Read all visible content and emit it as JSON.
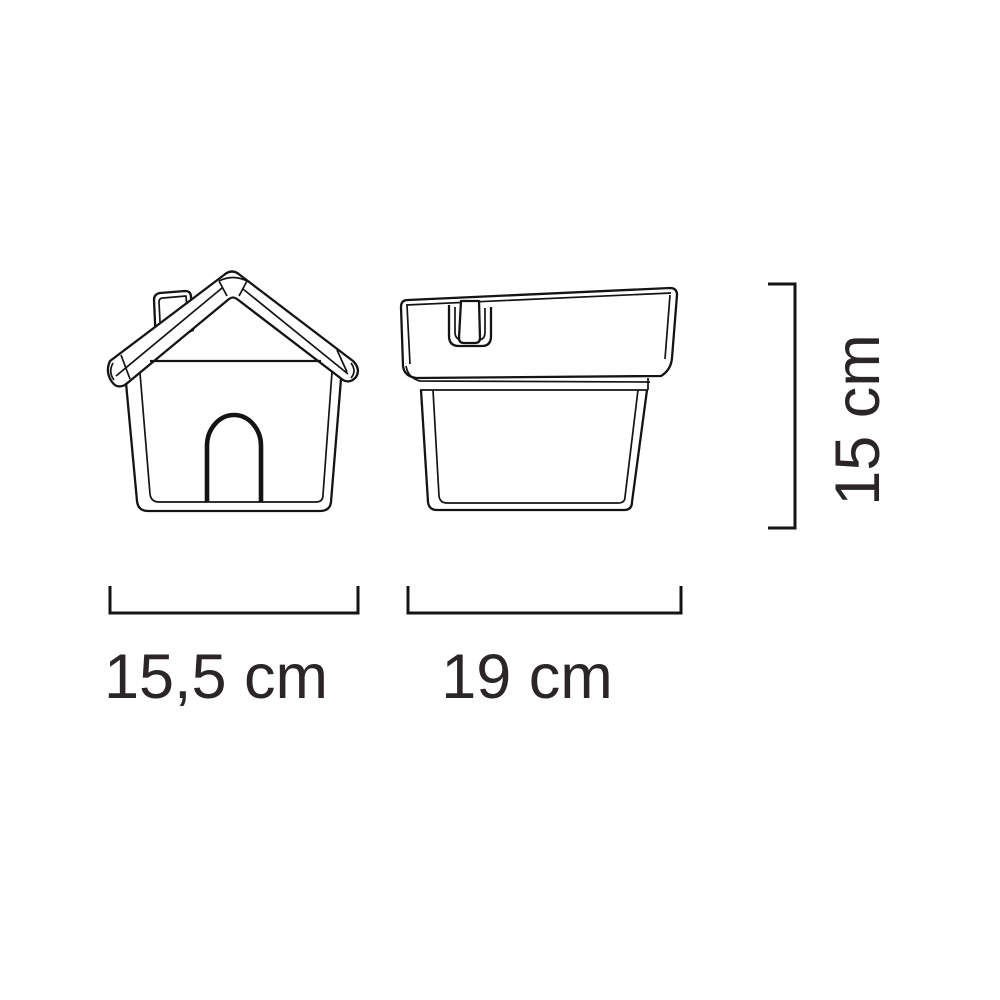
{
  "diagram": {
    "type": "product-dimension-drawing",
    "colors": {
      "background": "#ffffff",
      "line": "#141414",
      "text": "#2a2627"
    },
    "front_view": {
      "name": "front view",
      "width_label": "15,5 cm"
    },
    "side_view": {
      "name": "side view",
      "width_label": "19 cm"
    },
    "height_label": "15 cm",
    "unit": "cm"
  }
}
